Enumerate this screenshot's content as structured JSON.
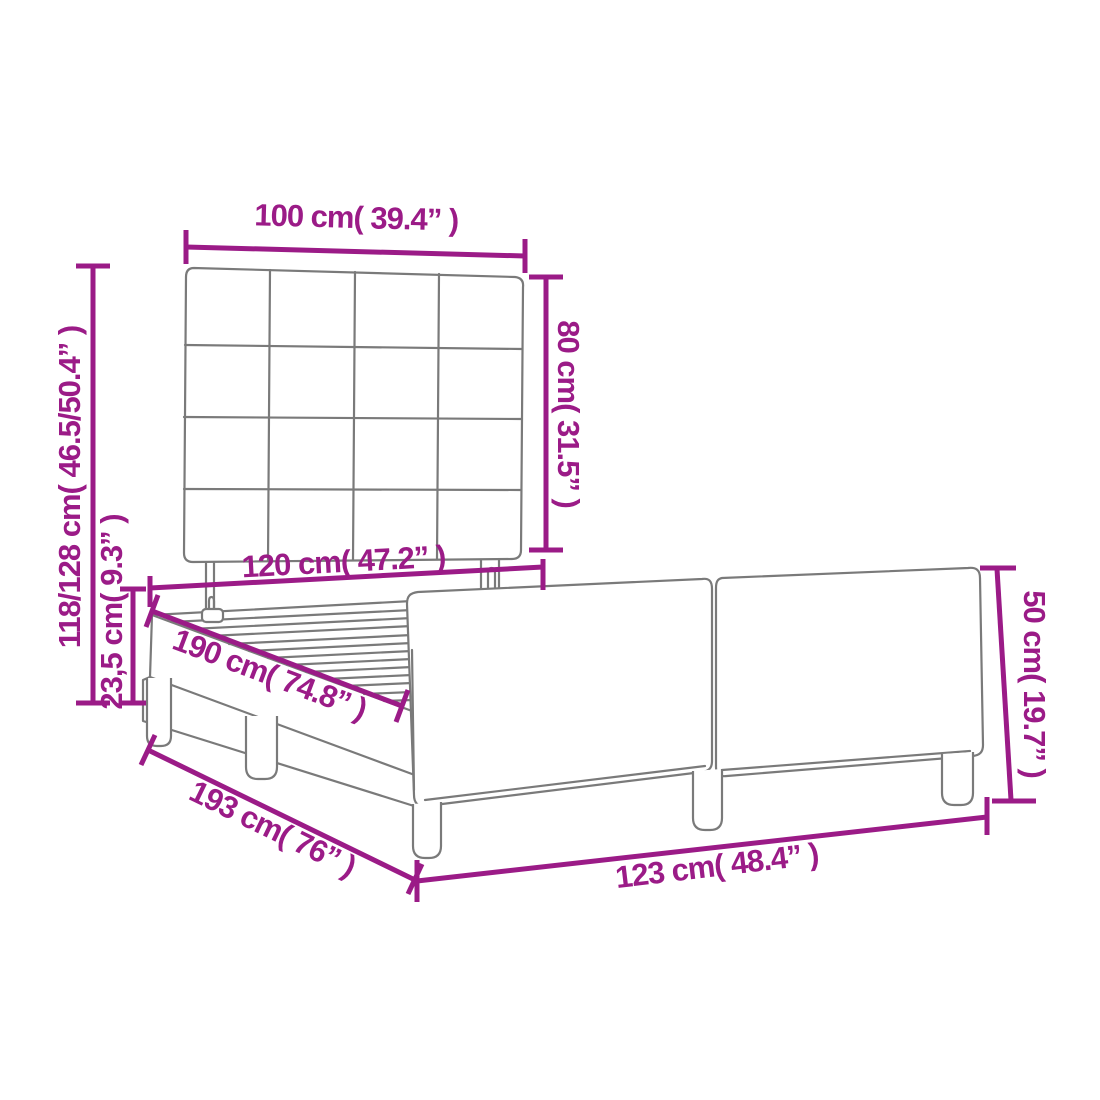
{
  "diagram": {
    "title": "Bed frame with tufted headboard - dimension diagram",
    "labels": {
      "headboard_width": "100 cm( 39.4” )",
      "headboard_height": "80 cm( 31.5” )",
      "overall_height": "118/128 cm( 46.5/50.4” )",
      "frame_height": "23,5 cm( 9.3” )",
      "inner_width": "120 cm( 47.2” )",
      "inner_length": "190 cm( 74.8” )",
      "overall_length": "193 cm( 76” )",
      "overall_width": "123 cm( 48.4” )",
      "footboard_height": "50 cm( 19.7” )"
    },
    "colors": {
      "dimension_accent": "#9b1b87",
      "outline_gray": "#7a7a7a",
      "background": "#ffffff"
    }
  }
}
